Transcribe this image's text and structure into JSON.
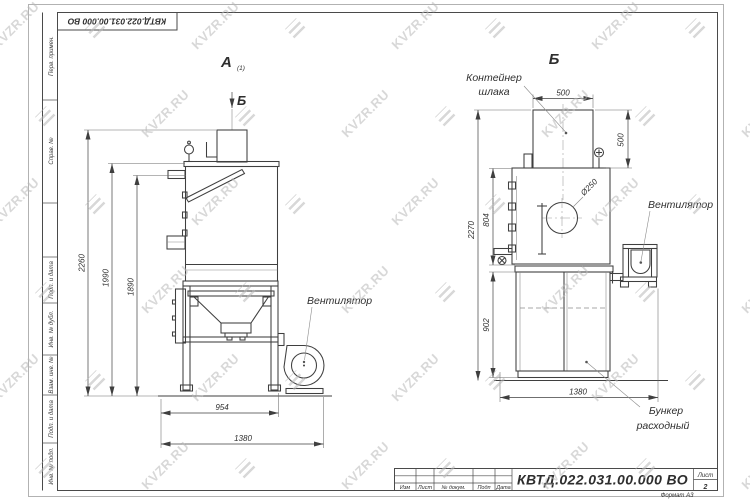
{
  "watermark": {
    "text": "KVZR.RU"
  },
  "sheet": {
    "stamp_top": "КВТД.022.031.00.000 ВО",
    "margin_labels": [
      "Перв. примен.",
      "Справ. №",
      "Подп. и дата",
      "Инв. № дубл.",
      "Взам. инв. №",
      "Подп. и дата",
      "Инв. № подл."
    ]
  },
  "views": {
    "a": {
      "label": "А",
      "label_index": "(1)",
      "section_arrow": "Б",
      "fan_label": "Вентилятор",
      "dims": {
        "total_height": "2260",
        "body_height": "1990",
        "lid_height": "1890",
        "frame_width": "954",
        "total_width": "1380"
      }
    },
    "b": {
      "label": "Б",
      "container_label_1": "Контейнер",
      "container_label_2": "шлака",
      "fan_label": "Вентилятор",
      "bunker_label_1": "Бункер",
      "bunker_label_2": "расходный",
      "dims": {
        "container_width": "500",
        "container_height": "500",
        "total_height": "2270",
        "chamber_height": "804",
        "bunker_height": "902",
        "total_depth": "1380",
        "inlet_diameter": "Ø250"
      }
    }
  },
  "title_block": {
    "doc_number": "КВТД.022.031.00.000  ВО",
    "revision_headers": [
      "Изм",
      "Лист",
      "№ докум.",
      "Подп",
      "Дата"
    ],
    "sheet_label": "Лист",
    "sheet_number": "2",
    "format_label": "Формат А3"
  }
}
